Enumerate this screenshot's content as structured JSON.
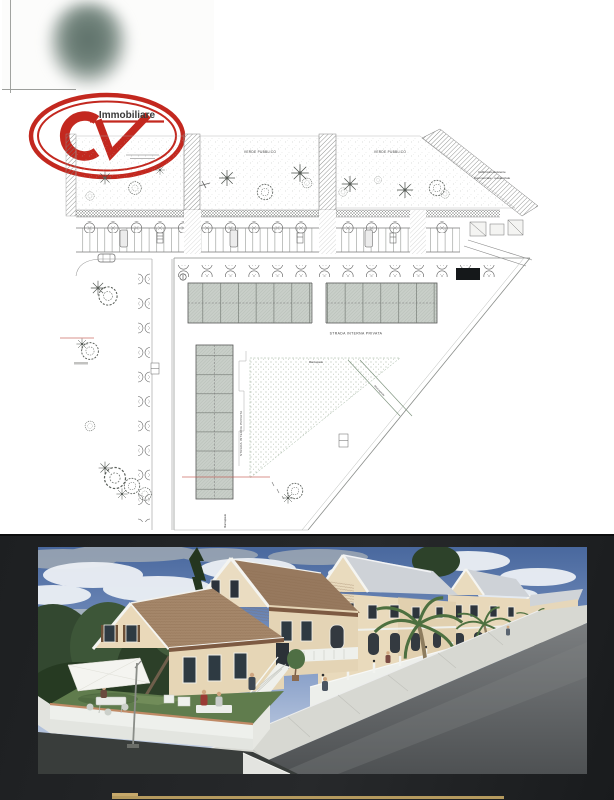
{
  "page": {
    "background": "#ffffff"
  },
  "logo": {
    "initials": "CV",
    "brand": "Immobiliare",
    "color": "#c3281f"
  },
  "site_plan": {
    "labels": {
      "verde_pubblico": "VERDE PUBBLICO",
      "fabbricato_line1": "Fabbricato Esistente",
      "fabbricato_line2": "Commerciale - residenziale",
      "strada_interna_privata": "STRADA INTERNA PRIVATA",
      "marciapiede": "Marciapiede"
    }
  },
  "photo_panel": {
    "background": "#212325",
    "divider_color": "#b59a5e"
  },
  "icons": {
    "tree-icon": "dashed double circle",
    "palm-tree-icon": "radial star lines",
    "street-tree-icon": "small outlined circle",
    "car-icon": "rounded rectangle",
    "umbrella-icon": "white tilted quad on pole"
  }
}
